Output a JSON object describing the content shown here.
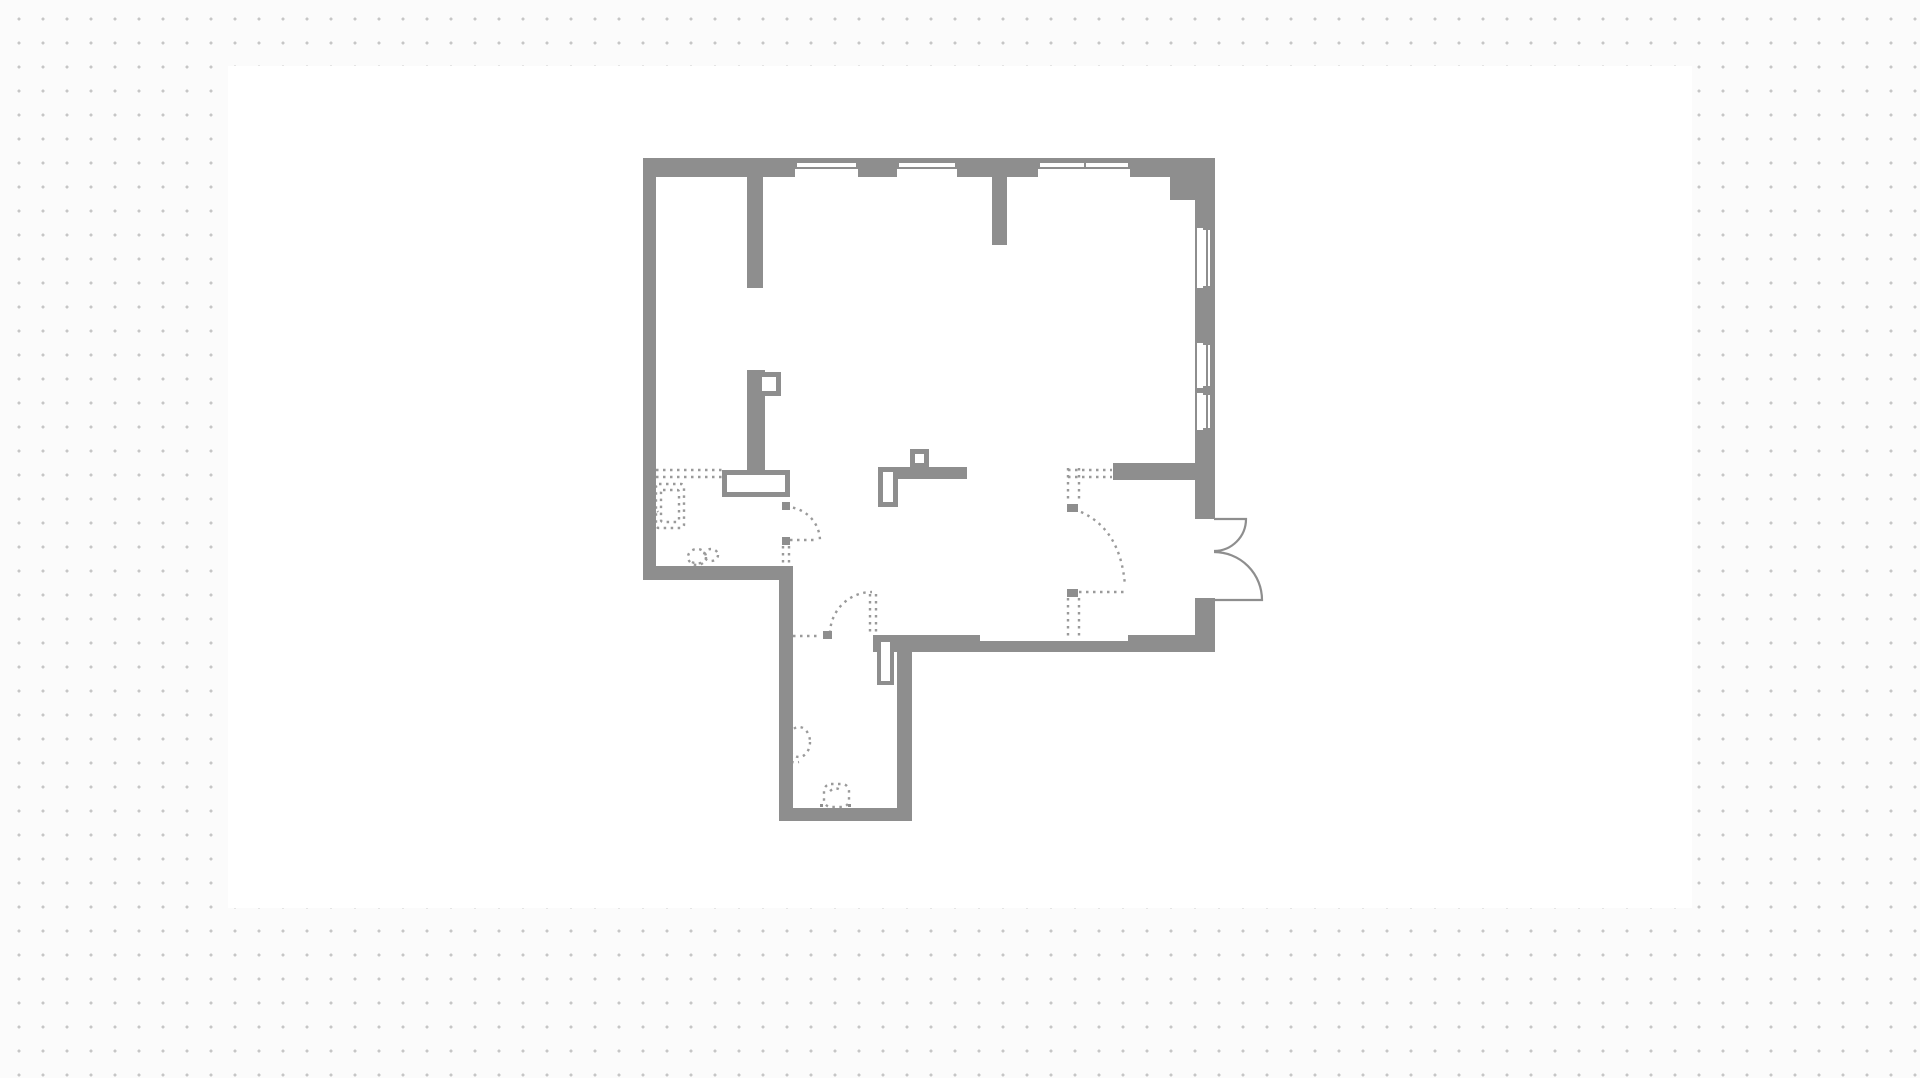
{
  "canvas": {
    "background_color": "#fbfbfb",
    "dot_color": "#c6c6c6",
    "dot_spacing_px": 24,
    "artboard": {
      "x": 228,
      "y": 66,
      "w": 1464,
      "h": 842,
      "color": "#ffffff"
    }
  },
  "palette": {
    "wall": "#8e8e8e",
    "dashed": "#9a9a9a",
    "white": "#ffffff"
  },
  "floorplan": {
    "walls": [
      {
        "name": "top-wall-exterior",
        "x": 643,
        "y": 158,
        "w": 572,
        "h": 19
      },
      {
        "name": "left-wall-exterior",
        "x": 643,
        "y": 158,
        "w": 13,
        "h": 422
      },
      {
        "name": "top-right-corner-block",
        "x": 1170,
        "y": 177,
        "w": 45,
        "h": 23
      },
      {
        "name": "right-wall-upper",
        "x": 1195,
        "y": 200,
        "w": 20,
        "h": 319
      },
      {
        "name": "right-wall-lower",
        "x": 1195,
        "y": 598,
        "w": 20,
        "h": 54
      },
      {
        "name": "bottom-wall-right",
        "x": 1128,
        "y": 635,
        "w": 87,
        "h": 17
      },
      {
        "name": "bottom-wall-middle",
        "x": 980,
        "y": 641,
        "w": 148,
        "h": 11
      },
      {
        "name": "bottom-wall-left",
        "x": 873,
        "y": 635,
        "w": 107,
        "h": 17
      },
      {
        "name": "interior-wall-entry",
        "x": 1113,
        "y": 463,
        "w": 82,
        "h": 17
      },
      {
        "name": "left-room-bottom-wall",
        "x": 643,
        "y": 566,
        "w": 150,
        "h": 14
      },
      {
        "name": "corridor-left-wall",
        "x": 779,
        "y": 566,
        "w": 14,
        "h": 255
      },
      {
        "name": "corridor-bottom-wall",
        "x": 779,
        "y": 808,
        "w": 133,
        "h": 13
      },
      {
        "name": "corridor-right-wall",
        "x": 897,
        "y": 650,
        "w": 15,
        "h": 171
      },
      {
        "name": "pillar-top-left",
        "x": 747,
        "y": 177,
        "w": 16,
        "h": 111
      },
      {
        "name": "pillar-top-right",
        "x": 992,
        "y": 177,
        "w": 15,
        "h": 68
      },
      {
        "name": "kitchen-peninsula-wall",
        "x": 747,
        "y": 370,
        "w": 18,
        "h": 107
      },
      {
        "name": "island-bar",
        "x": 878,
        "y": 467,
        "w": 89,
        "h": 12
      }
    ],
    "windows": [
      {
        "name": "window-top-1",
        "orient": "h",
        "x": 795,
        "y": 163,
        "w": 63,
        "h": 14
      },
      {
        "name": "window-top-2",
        "orient": "h",
        "x": 897,
        "y": 163,
        "w": 60,
        "h": 14
      },
      {
        "name": "window-top-3",
        "orient": "h",
        "x": 1038,
        "y": 163,
        "w": 92,
        "h": 14,
        "mid": 1085
      },
      {
        "name": "window-right-1",
        "orient": "v",
        "x": 1197,
        "y": 228,
        "w": 13,
        "h": 60
      },
      {
        "name": "window-right-2",
        "orient": "v",
        "x": 1197,
        "y": 343,
        "w": 13,
        "h": 45
      },
      {
        "name": "window-right-3",
        "orient": "v",
        "x": 1197,
        "y": 393,
        "w": 13,
        "h": 37
      }
    ],
    "hollow_boxes": [
      {
        "name": "kitchen-box-small",
        "x": 757,
        "y": 372,
        "w": 24,
        "h": 24,
        "b": 5
      },
      {
        "name": "kitchen-box-large",
        "x": 722,
        "y": 470,
        "w": 68,
        "h": 27,
        "b": 5
      },
      {
        "name": "island-box-small",
        "x": 910,
        "y": 449,
        "w": 19,
        "h": 19,
        "b": 5
      },
      {
        "name": "island-box-tall",
        "x": 878,
        "y": 467,
        "w": 20,
        "h": 40,
        "b": 5
      },
      {
        "name": "corridor-door-leaf",
        "x": 877,
        "y": 638,
        "w": 17,
        "h": 47,
        "b": 4
      }
    ],
    "hinges": [
      {
        "name": "hinge-kitchen-door-top",
        "x": 782,
        "y": 502,
        "w": 8,
        "h": 8
      },
      {
        "name": "hinge-kitchen-door-bottom",
        "x": 782,
        "y": 537,
        "w": 8,
        "h": 8
      },
      {
        "name": "hinge-corridor-door",
        "x": 823,
        "y": 631,
        "w": 9,
        "h": 8
      },
      {
        "name": "hinge-wardrobe-top",
        "x": 1067,
        "y": 504,
        "w": 11,
        "h": 8
      },
      {
        "name": "hinge-wardrobe-bottom",
        "x": 1067,
        "y": 589,
        "w": 11,
        "h": 8
      },
      {
        "name": "dot-fixture-left",
        "x": 820,
        "y": 804,
        "w": 3,
        "h": 3
      },
      {
        "name": "dot-fixture-right",
        "x": 848,
        "y": 804,
        "w": 3,
        "h": 3
      }
    ],
    "solid_paths": [
      {
        "name": "french-door-top-leaf",
        "d": "M 1214 519 L 1246 519 A 32 32 0 0 1 1214 551"
      },
      {
        "name": "french-door-bottom-leaf",
        "d": "M 1214 600 L 1262 600 A 48 48 0 0 0 1214 552"
      }
    ],
    "dashed_paths": [
      {
        "name": "kitchen-counter-line-1",
        "d": "M 656 470 L 722 470"
      },
      {
        "name": "kitchen-counter-line-2",
        "d": "M 656 477 L 722 477"
      },
      {
        "name": "kitchen-wall-tick",
        "d": "M 649 500 L 658 512"
      },
      {
        "name": "entry-counter-line-1",
        "d": "M 1068 470 L 1112 470"
      },
      {
        "name": "entry-counter-line-2",
        "d": "M 1068 477 L 1112 477"
      },
      {
        "name": "kitchen-door-arc",
        "d": "M 786 507 A 34 34 0 0 1 820 541"
      },
      {
        "name": "kitchen-door-leaf-line",
        "d": "M 790 540 L 818 540"
      },
      {
        "name": "kitchen-door-jamb-1",
        "d": "M 783 546 L 783 566"
      },
      {
        "name": "kitchen-door-jamb-2",
        "d": "M 789 546 L 789 566"
      },
      {
        "name": "corridor-door-line",
        "d": "M 793 636 L 821 636"
      },
      {
        "name": "corridor-door-arc",
        "d": "M 830 633 A 42 42 0 0 1 872 592"
      },
      {
        "name": "corridor-door-jamb-1",
        "d": "M 870 594 L 870 634"
      },
      {
        "name": "corridor-door-jamb-2",
        "d": "M 876 594 L 876 634"
      },
      {
        "name": "wardrobe-side-top-1",
        "d": "M 1068 468 L 1068 502"
      },
      {
        "name": "wardrobe-side-top-2",
        "d": "M 1079 468 L 1079 502"
      },
      {
        "name": "wardrobe-side-bottom-1",
        "d": "M 1068 598 L 1068 637"
      },
      {
        "name": "wardrobe-side-bottom-2",
        "d": "M 1079 598 L 1079 637"
      },
      {
        "name": "wardrobe-door-arc",
        "d": "M 1081 512 Q 1121 530 1125 586"
      },
      {
        "name": "wardrobe-door-line",
        "d": "M 1079 592 L 1125 592"
      },
      {
        "name": "pet-bowl-inner-line",
        "d": "M 692 562 Q 697 565 703 562"
      },
      {
        "name": "toilet-tail-line",
        "d": "M 786 757 Q 791 764 799 762"
      },
      {
        "name": "sink-inner-line",
        "d": "M 830 791 Q 836 786 842 791"
      }
    ],
    "dashed_rects": [
      {
        "name": "appliance-outline-outer",
        "x": 656,
        "y": 484,
        "w": 28,
        "h": 44,
        "r": 3
      },
      {
        "name": "appliance-outline-inner",
        "x": 661,
        "y": 490,
        "w": 18,
        "h": 32,
        "r": 2
      },
      {
        "name": "sink-outline",
        "x": 824,
        "y": 784,
        "w": 25,
        "h": 23,
        "r": 7
      }
    ],
    "dashed_ellipses": [
      {
        "name": "pet-bowl-left",
        "cx": 697,
        "cy": 557,
        "rx": 9,
        "ry": 8
      },
      {
        "name": "pet-bowl-right",
        "cx": 711,
        "cy": 555,
        "rx": 7,
        "ry": 6
      },
      {
        "name": "toilet-outline",
        "cx": 799,
        "cy": 742,
        "rx": 11,
        "ry": 15
      }
    ]
  }
}
